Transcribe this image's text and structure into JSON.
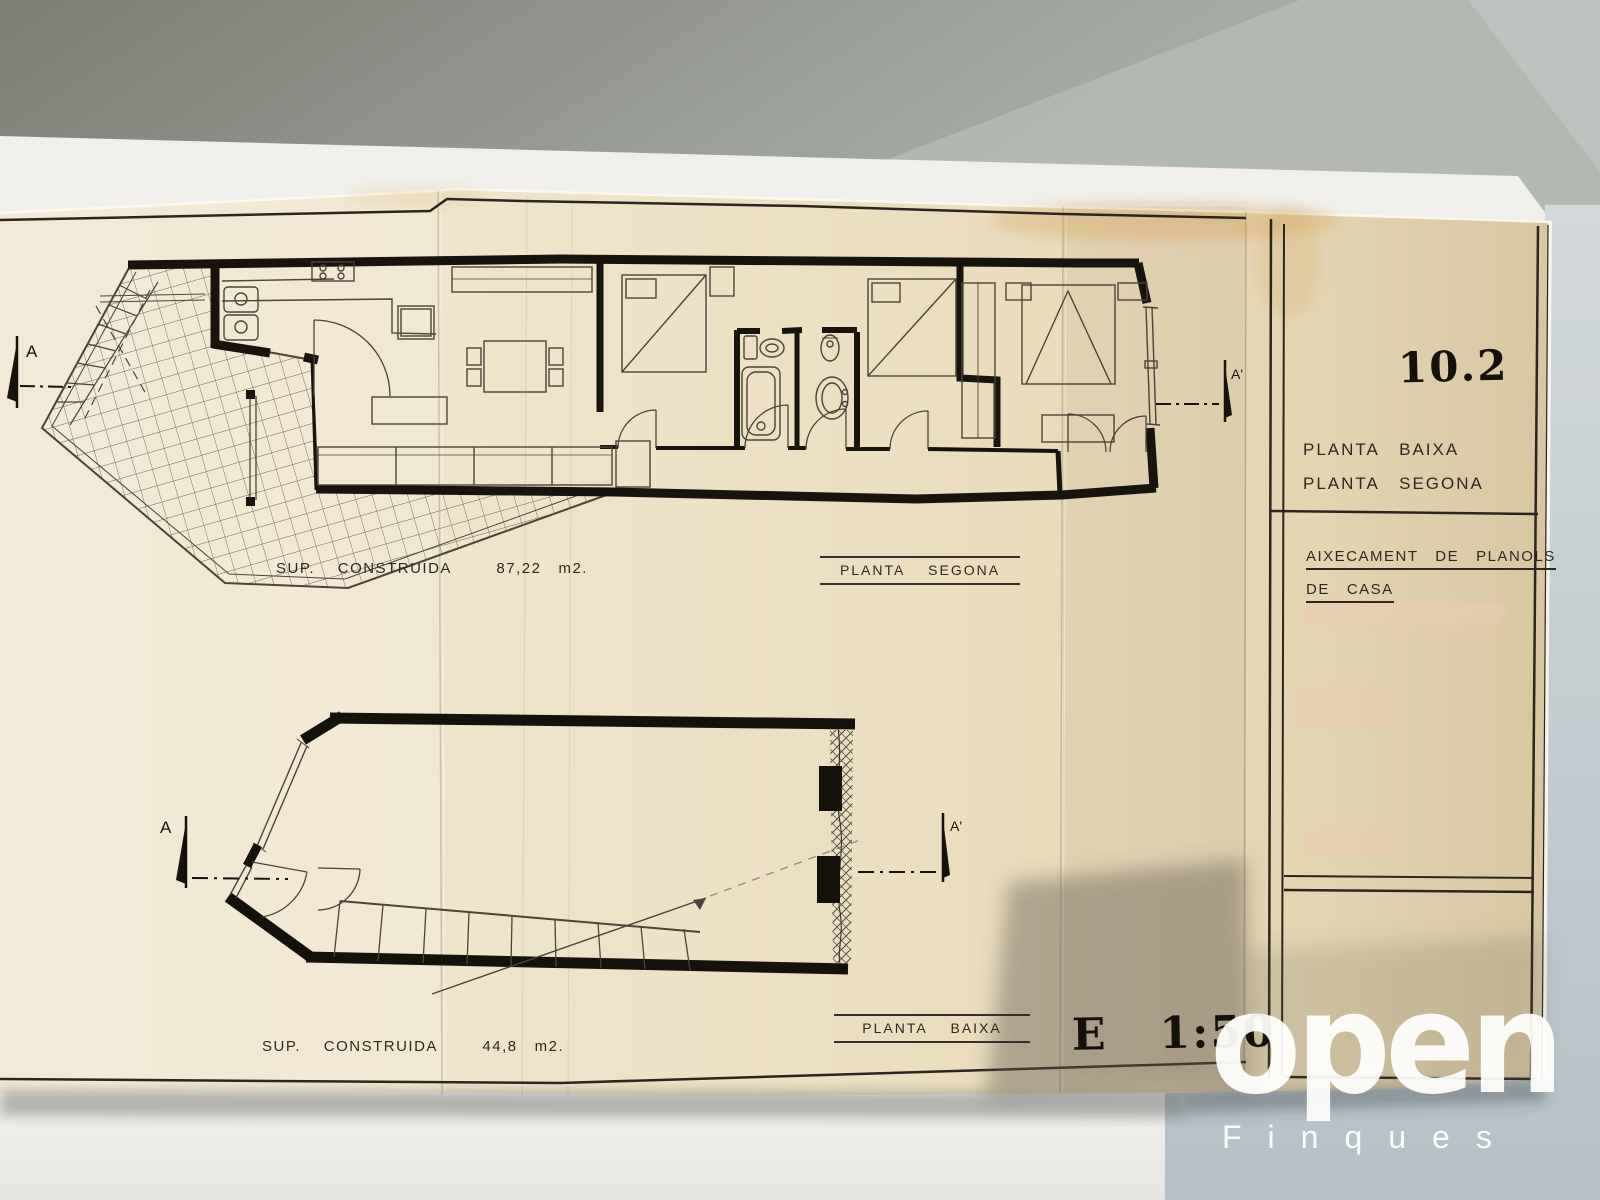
{
  "photo": {
    "wall_color": "#9aa09a",
    "paper_color": "#ece1c5",
    "ink_color": "#17130c",
    "shadow_wall_color": "#c3ced3",
    "watermark_color": "#ffffff"
  },
  "upper_plan": {
    "area_text": "SUP.    CONSTRUIDA        87,22   m2.",
    "caption": "PLANTA    SEGONA",
    "section_start_label": "A",
    "section_end_label": "A'"
  },
  "lower_plan": {
    "area_text": "SUP.    CONSTRUIDA        44,8   m2.",
    "caption": "PLANTA    BAIXA",
    "section_start_label": "A",
    "section_end_label": "A'"
  },
  "title_block": {
    "sheet_number": "10.2",
    "plan_names": [
      "PLANTA   BAIXA",
      "PLANTA   SEGONA"
    ],
    "project_line1": "AIXECAMENT   DE   PLANOLS",
    "project_line2": "DE   CASA"
  },
  "scale_label": "E   1:50",
  "watermark": {
    "brand": "open",
    "tagline": "Finques"
  }
}
